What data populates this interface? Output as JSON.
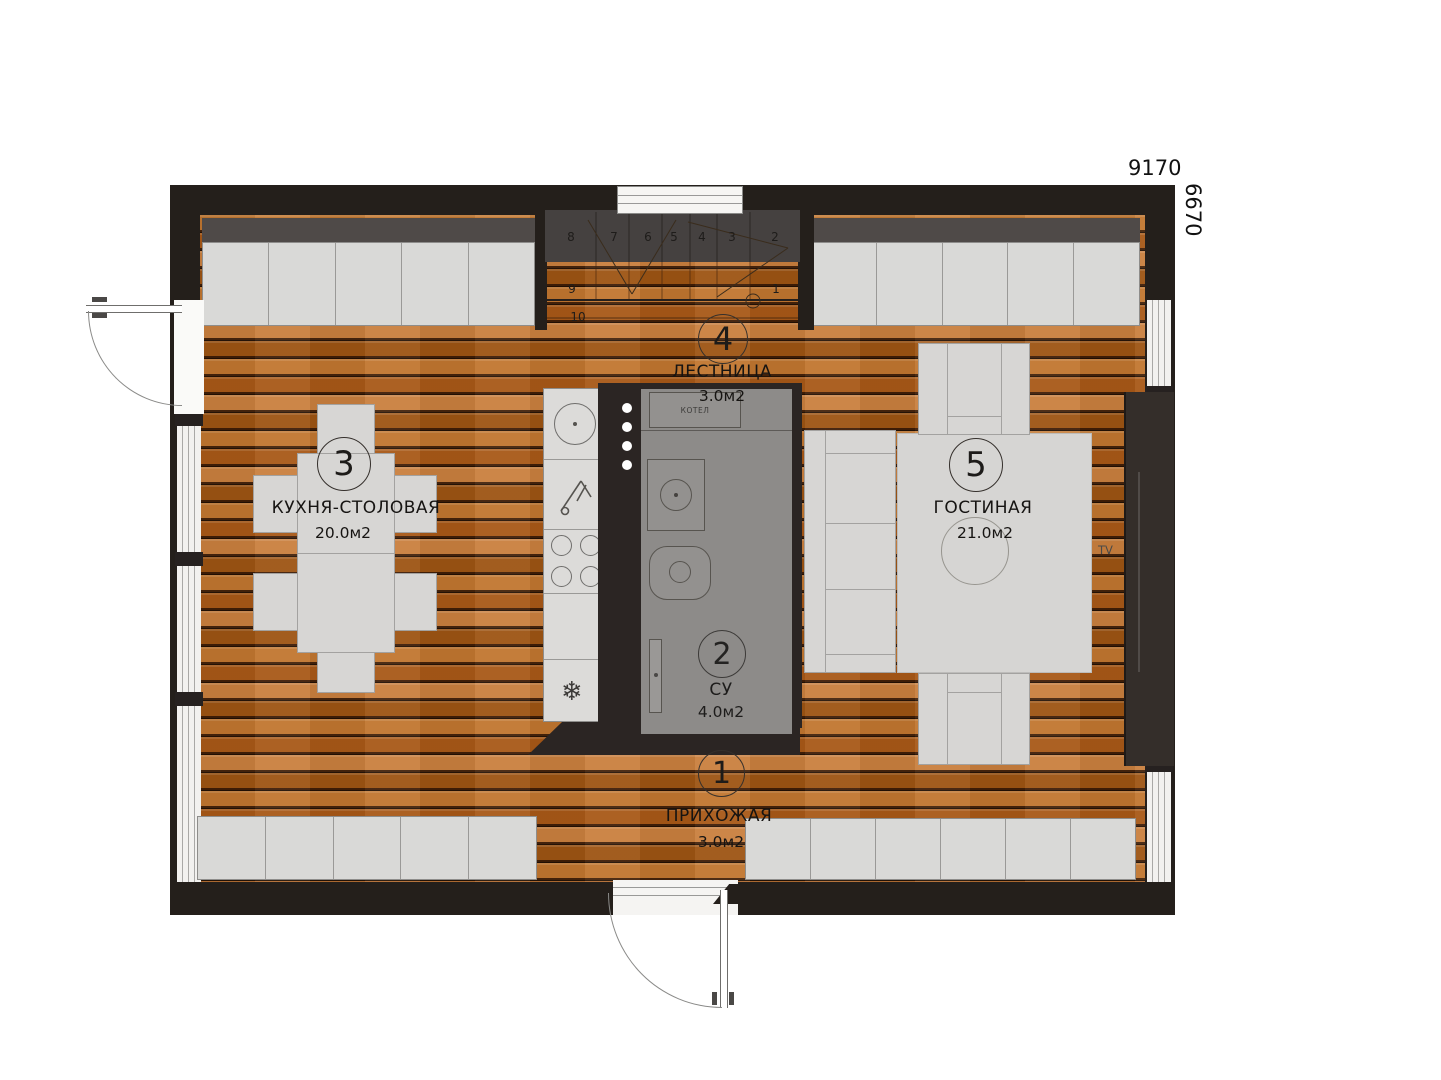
{
  "dimensions": {
    "width_mm": "9170",
    "height_mm": "6670"
  },
  "rooms": [
    {
      "num": "1",
      "name": "ПРИХОЖАЯ",
      "area": "3.0м2"
    },
    {
      "num": "2",
      "name": "СУ",
      "area": "4.0м2"
    },
    {
      "num": "3",
      "name": "КУХНЯ-СТОЛОВАЯ",
      "area": "20.0м2"
    },
    {
      "num": "4",
      "name": "ЛЕСТНИЦА",
      "area": "3.0м2"
    },
    {
      "num": "5",
      "name": "ГОСТИНАЯ",
      "area": "21.0м2"
    }
  ],
  "stairs": {
    "steps": [
      "1",
      "2",
      "3",
      "4",
      "5",
      "6",
      "7",
      "8",
      "9",
      "10"
    ]
  },
  "equipment": {
    "boiler": "КОТЕЛ",
    "tv": "TV"
  },
  "icons": {
    "snowflake": "❄"
  },
  "colors": {
    "wood": "#b4641e",
    "outer_wall": "#241f1b",
    "core": "#2b2523",
    "bathroom_floor": "#8d8b89",
    "cabinet": "#d9d9d7",
    "furniture": "#d7d6d4"
  }
}
